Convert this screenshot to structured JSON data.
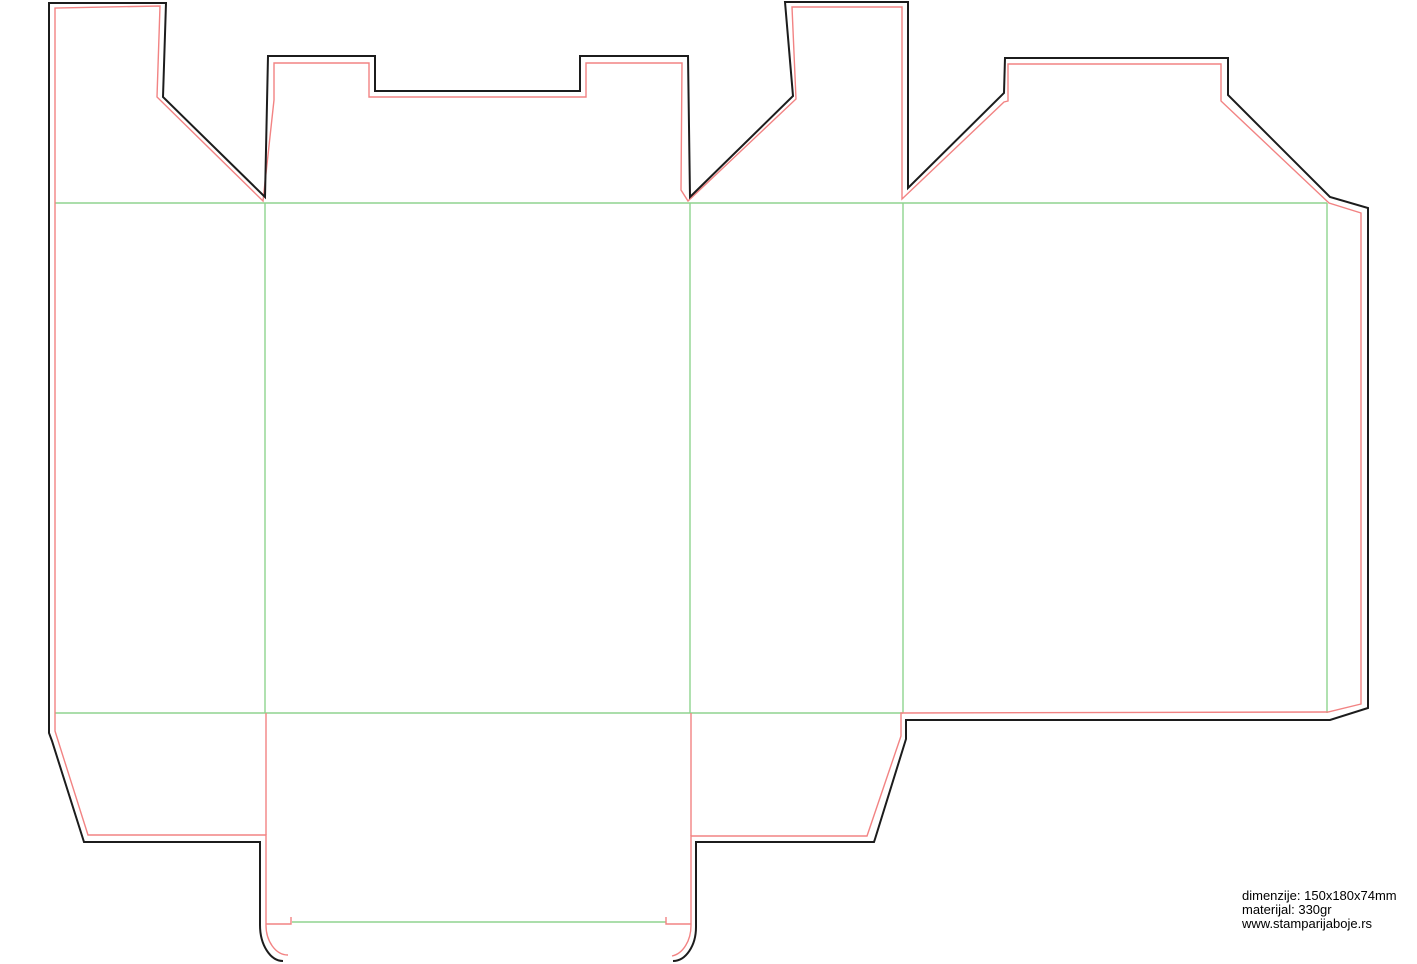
{
  "footer": {
    "line1": "dimenzije: 150x180x74mm",
    "line2": "materijal: 330gr",
    "line3": "www.stamparijaboje.rs"
  },
  "colors": {
    "background": "#ffffff",
    "cut": "#1c1c1c",
    "bleed": "#f28383",
    "fold": "#8fd48f",
    "text": "#000000"
  },
  "dieline": {
    "dimensions_mm": "150x180x74",
    "material": "330gr",
    "line_roles": {
      "black": "cut line",
      "red": "inner safety / bleed offset line",
      "green": "fold (crease) line"
    }
  }
}
